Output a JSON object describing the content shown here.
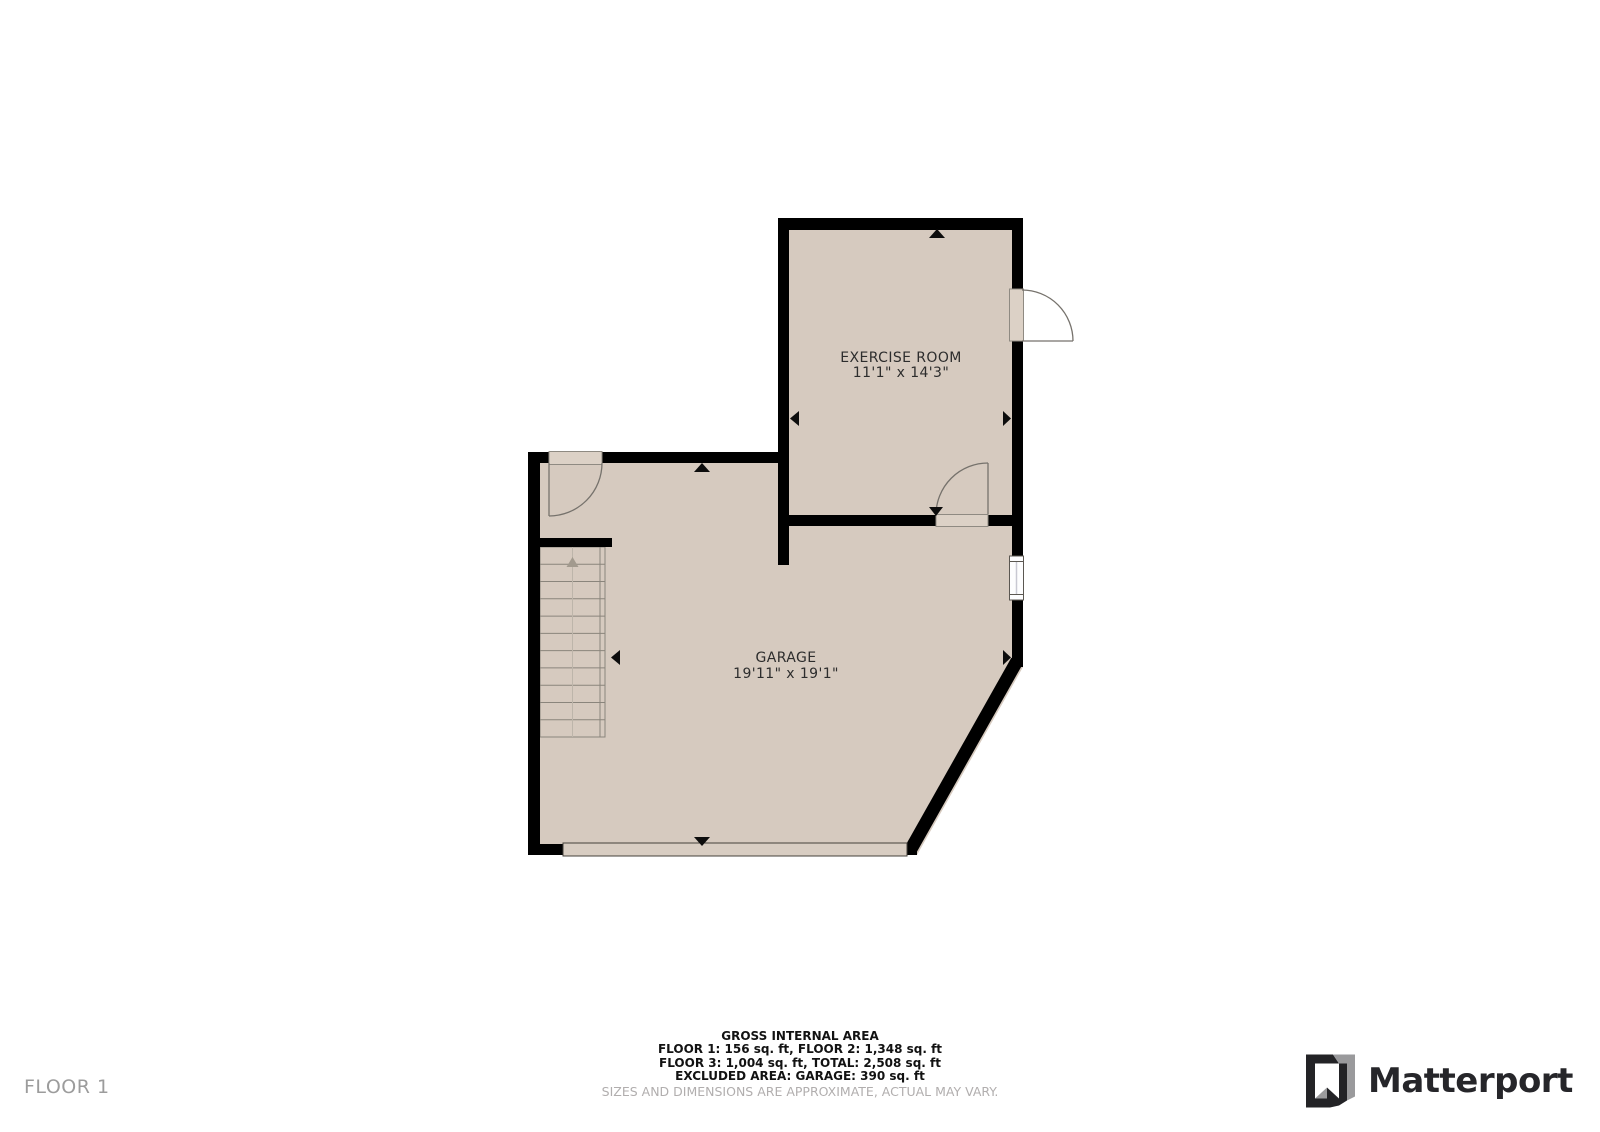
{
  "floor_label": "FLOOR 1",
  "rooms": {
    "exercise": {
      "name": "EXERCISE ROOM",
      "dimensions": "11'1\" x 14'3\""
    },
    "garage": {
      "name": "GARAGE",
      "dimensions": "19'11\" x 19'1\""
    }
  },
  "footer": {
    "title": "GROSS INTERNAL AREA",
    "line1": "FLOOR 1: 156 sq. ft, FLOOR 2: 1,348 sq. ft",
    "line2": "FLOOR 3: 1,004 sq. ft, TOTAL: 2,508 sq. ft",
    "line3": "EXCLUDED AREA: GARAGE: 390 sq. ft",
    "disclaimer": "SIZES AND DIMENSIONS ARE APPROXIMATE, ACTUAL MAY VARY."
  },
  "branding": {
    "logo_text": "Matterport"
  },
  "colors": {
    "floor_fill": "#d6cabf",
    "wall": "#000000",
    "door_leaf": "#dcd1c6",
    "muted_text": "#9c9c9c",
    "logo_dark": "#26262a",
    "logo_gray": "#9a9a9c"
  }
}
